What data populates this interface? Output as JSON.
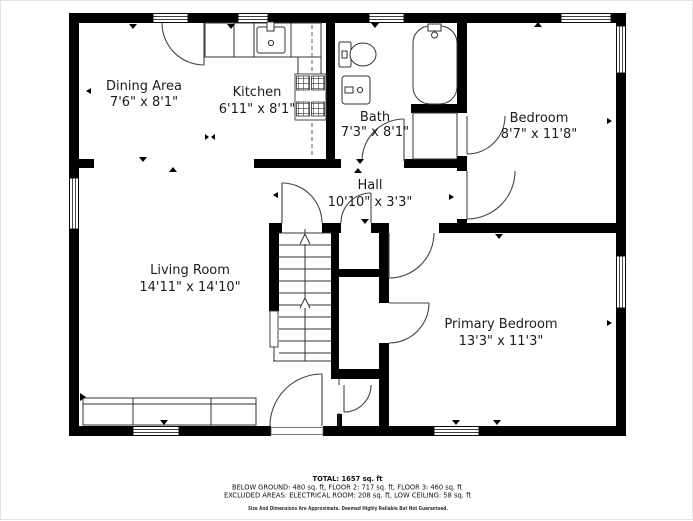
{
  "plan": {
    "rooms": [
      {
        "name": "Dining Area",
        "dims": "7'6\" x 8'1\""
      },
      {
        "name": "Kitchen",
        "dims": "6'11\" x 8'1\""
      },
      {
        "name": "Bath",
        "dims": "7'3\" x 8'1\""
      },
      {
        "name": "Bedroom",
        "dims": "8'7\" x 11'8\""
      },
      {
        "name": "Hall",
        "dims": "10'10\" x 3'3\""
      },
      {
        "name": "Living Room",
        "dims": "14'11\" x 14'10\""
      },
      {
        "name": "Primary Bedroom",
        "dims": "13'3\" x 11'3\""
      }
    ],
    "fixtures": [
      "kitchen-sink",
      "stove",
      "kitchen-counter",
      "toilet",
      "bathroom-sink",
      "bathtub",
      "bedroom-closet",
      "staircase",
      "hall-closet",
      "entry-closet",
      "sofa"
    ],
    "wall_color": "#000000",
    "background_color": "#ffffff"
  },
  "footer": {
    "total": "TOTAL: 1657 sq. ft",
    "floors": "BELOW GROUND: 480 sq. ft, FLOOR 2: 717 sq. ft, FLOOR 3: 460 sq. ft",
    "excluded": "EXCLUDED AREAS: ELECTRICAL ROOM: 208 sq. ft, LOW CEILING: 58 sq. ft",
    "disclaimer": "Size And Dimensions Are Approximate. Deemed Highly Reliable But Not Guaranteed."
  }
}
